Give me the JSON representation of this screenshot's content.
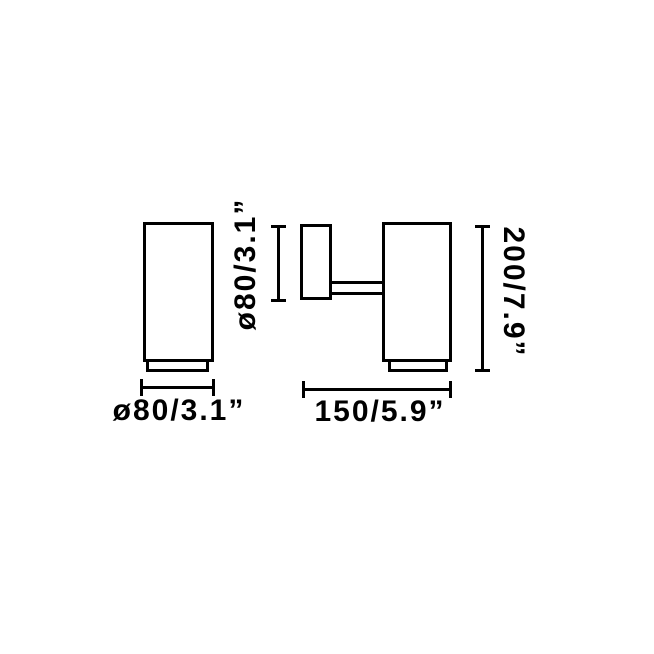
{
  "diagram": {
    "subject": "Cylindrical wall spotlight technical dimension drawing",
    "background_color": "#ffffff",
    "stroke_color": "#000000",
    "views": [
      {
        "id": "front-view",
        "description": "lamp cylinder seen from the front with trim ring at bottom"
      },
      {
        "id": "side-view",
        "description": "wall canopy connected by an arm to the lamp cylinder"
      }
    ],
    "dimensions": {
      "front_diameter": {
        "label": "ø80/3.1”",
        "millimeters": "80",
        "inches": "3.1",
        "orientation": "horizontal",
        "measures": "cylinder diameter (front view)"
      },
      "canopy_diameter": {
        "label": "ø80/3.1”",
        "millimeters": "80",
        "inches": "3.1",
        "orientation": "vertical",
        "measures": "wall canopy diameter (side view)"
      },
      "projection": {
        "label": "150/5.9”",
        "millimeters": "150",
        "inches": "5.9",
        "orientation": "horizontal",
        "measures": "total projection from wall"
      },
      "height": {
        "label": "200/7.9”",
        "millimeters": "200",
        "inches": "7.9",
        "orientation": "vertical",
        "measures": "total height of cylinder"
      }
    }
  }
}
